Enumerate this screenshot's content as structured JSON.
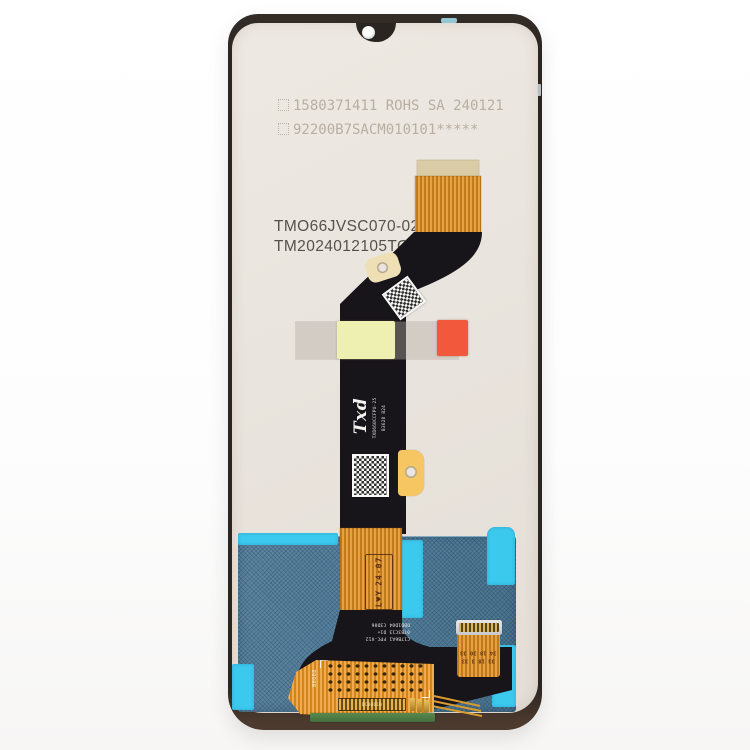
{
  "description": "Product photo: rear view of a smartphone LCD display and digitizer assembly spare part, off-white panel back with black and orange flex ribbon cables, stickers, QR labels and a teal backlight section at the bottom",
  "colors": {
    "background": "#ffffff",
    "frame": "#2b2521",
    "panel_back": "#e9e4dd",
    "flex_orange": "#e5a144",
    "flex_black": "#18151a",
    "backlight_teal": "#54809e",
    "tape_cyan": "#3cc9ee",
    "sticker_yellow": "#eef0b2",
    "sticker_red": "#f2583c",
    "stiffener_tan": "#d9cca6",
    "pcb_green": "#4e7c46",
    "gold": "#d4a843"
  },
  "markings": {
    "etched_line1": "1580371411 ROHS SA 240121",
    "etched_line2": "92200B7SACM010101*****",
    "model_line1": "TMO66JVSC070-02",
    "model_line2": "TM2024012105TOVTB",
    "flex_brand": "Txd",
    "flex_brand_model": "TXD660CCFPU-25",
    "flex_brand_batch": "B3628 B24",
    "date_stamp_line1": "L♥Y",
    "date_stamp_line2": "24·07",
    "flex_marking_line1": "C17B6A1 FPC-V12",
    "flex_marking_line2": "07B3C13 D1+",
    "flex_marking_line3": "DBD1D04 C3D06",
    "connector_marking_line1": "33 18 3 33",
    "connector_marking_line2": "34 18 30 33",
    "board_stamp": "B0608",
    "gold_connector_marking": "DC80610"
  }
}
